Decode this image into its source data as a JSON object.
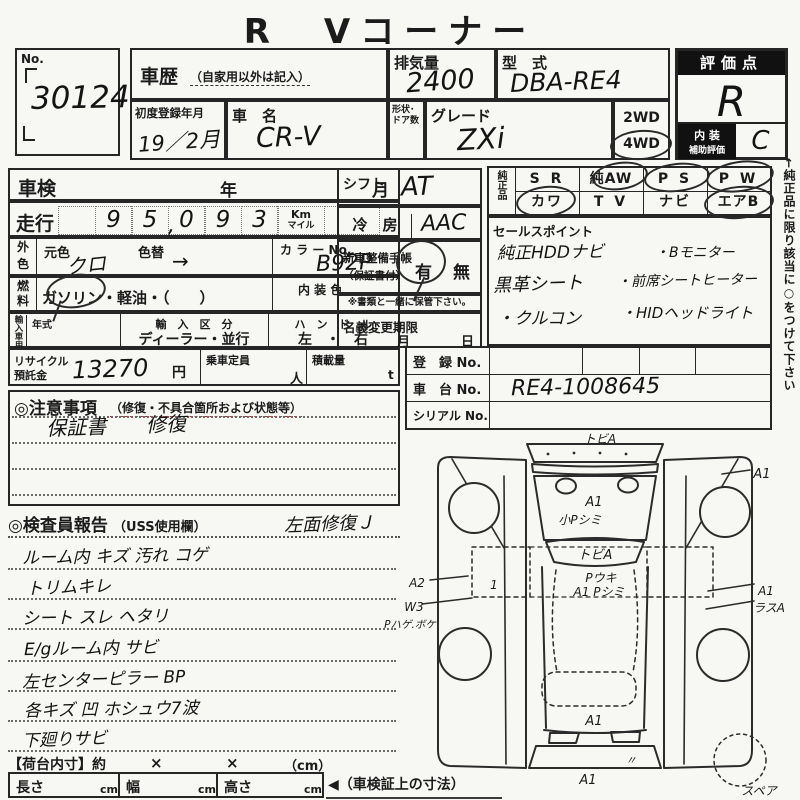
{
  "title": "R　Vコーナー",
  "no_box": {
    "label": "No.",
    "value": "30124"
  },
  "header": {
    "history_label": "車歴",
    "history_note": "（自家用以外は記入）",
    "displacement_label": "排気量",
    "displacement_value": "2400",
    "model_label": "型　式",
    "model_value": "DBA-RE4",
    "first_reg_label": "初度登録年月",
    "first_reg_value": "19／2月",
    "name_label": "車　名",
    "name_value": "CR-V",
    "body_label": "形状･ドア数",
    "grade_label": "グレード",
    "grade_value": "ZXi",
    "wd2": "2WD",
    "wd4": "4WD"
  },
  "score": {
    "label": "評価点",
    "value": "R",
    "interior_label1": "内 装",
    "interior_label2": "補助評価",
    "interior_value": "C"
  },
  "shaken": {
    "label": "車検",
    "year": "年",
    "month": "月"
  },
  "mileage": {
    "label": "走行",
    "cells": [
      "",
      "9",
      "5",
      "0",
      "9",
      "3"
    ],
    "comma": ",",
    "unit_km": "Km",
    "unit_mile": "マイル"
  },
  "color": {
    "head1": "外",
    "head2": "色",
    "base_label": "元色",
    "base_value": "クロ",
    "change_label": "色替",
    "change_value": "→",
    "no_label": "カ ラ ー No.",
    "no_value": "B92P"
  },
  "fuel": {
    "head1": "燃",
    "head2": "料",
    "options": "ガソリン・軽油・（　　）",
    "interior_label": "内 装 色"
  },
  "import_row": {
    "head": "輸入車用",
    "year_label": "年式",
    "division_label": "輸　入　区　分",
    "division_value": "ディーラー・並行",
    "handle_label": "ハ　ン　ド　ル",
    "handle_value": "左　・　右"
  },
  "recycle": {
    "label1": "リサイクル",
    "label2": "預託金",
    "value": "13270",
    "unit": "円",
    "pax_label": "乗車定員",
    "pax_unit": "人",
    "load_label": "積載量",
    "load_unit": "t"
  },
  "shift": {
    "label": "シフト",
    "value": "AT"
  },
  "ac": {
    "label": "冷　房",
    "value": "AAC"
  },
  "book": {
    "label1": "新車整備手帳",
    "label2": "（保証書付）",
    "yes": "有",
    "no": "無",
    "note": "※書類と一緒に保管下さい。"
  },
  "name_change": {
    "label": "名義変更期限",
    "month": "月",
    "day": "日"
  },
  "genuine": {
    "head": "純正品",
    "row1": [
      "S R",
      "純AW",
      "P S",
      "P W"
    ],
    "row2": [
      "カワ",
      "T V",
      "ナビ",
      "エアB"
    ]
  },
  "sales": {
    "label": "セールスポイント",
    "items_left": [
      "純正HDDナビ",
      "黒革シート",
      "・クルコン"
    ],
    "items_right": [
      "・Bモニター",
      "・前席シートヒーター",
      "・HIDヘッドライト"
    ]
  },
  "margin_note": "←純正品に限り該当に○をつけて下さい",
  "registration": {
    "reg_label": "登　録 No.",
    "chassis_label": "車　台 No.",
    "chassis_value": "RE4-1008645",
    "serial_label": "シリアル No."
  },
  "cautions": {
    "label": "◎注意事項",
    "note": "（修復・不具合箇所および状態等）",
    "entry": "保証書　　修復"
  },
  "report": {
    "label": "◎検査員報告",
    "note": "（USS使用欄）",
    "side_entry": "左面修復Ｊ",
    "lines": [
      "ルーム内 キズ 汚れ コゲ",
      "トリムキレ",
      "シート スレ ヘタリ",
      "E/gルーム内 サビ",
      "左センターピラー BP",
      "各キズ 凹 ホシュウ7波",
      "下廻りサビ"
    ]
  },
  "cargo": {
    "label": "【荷台内寸】約",
    "x1": "×",
    "x2": "×",
    "unit": "（cm）",
    "len_label": "長さ",
    "wid_label": "幅",
    "hei_label": "高さ",
    "cm1": "cm",
    "cm2": "cm",
    "cm3": "cm",
    "arrow_note": "◀（車検証上の寸法）"
  },
  "diagram": {
    "front_tobi": "トビA",
    "hood_a1": "A1",
    "hood_shimi": "小Pシミ",
    "glass_tobi": "トビA",
    "roof_uki": "Pウキ",
    "roof_shimi": "A1 Pシミ",
    "rf_a1": "A1",
    "left_a2": "A2",
    "left_w3": "W3",
    "left_hage": "Pハゲ.ボケ",
    "door_1": "1",
    "right_a1": "A1",
    "right_rasu": "ラスA",
    "tail_a1": "A1",
    "ditto": "〃",
    "rear_a1": "A1",
    "spare": "スペア"
  }
}
